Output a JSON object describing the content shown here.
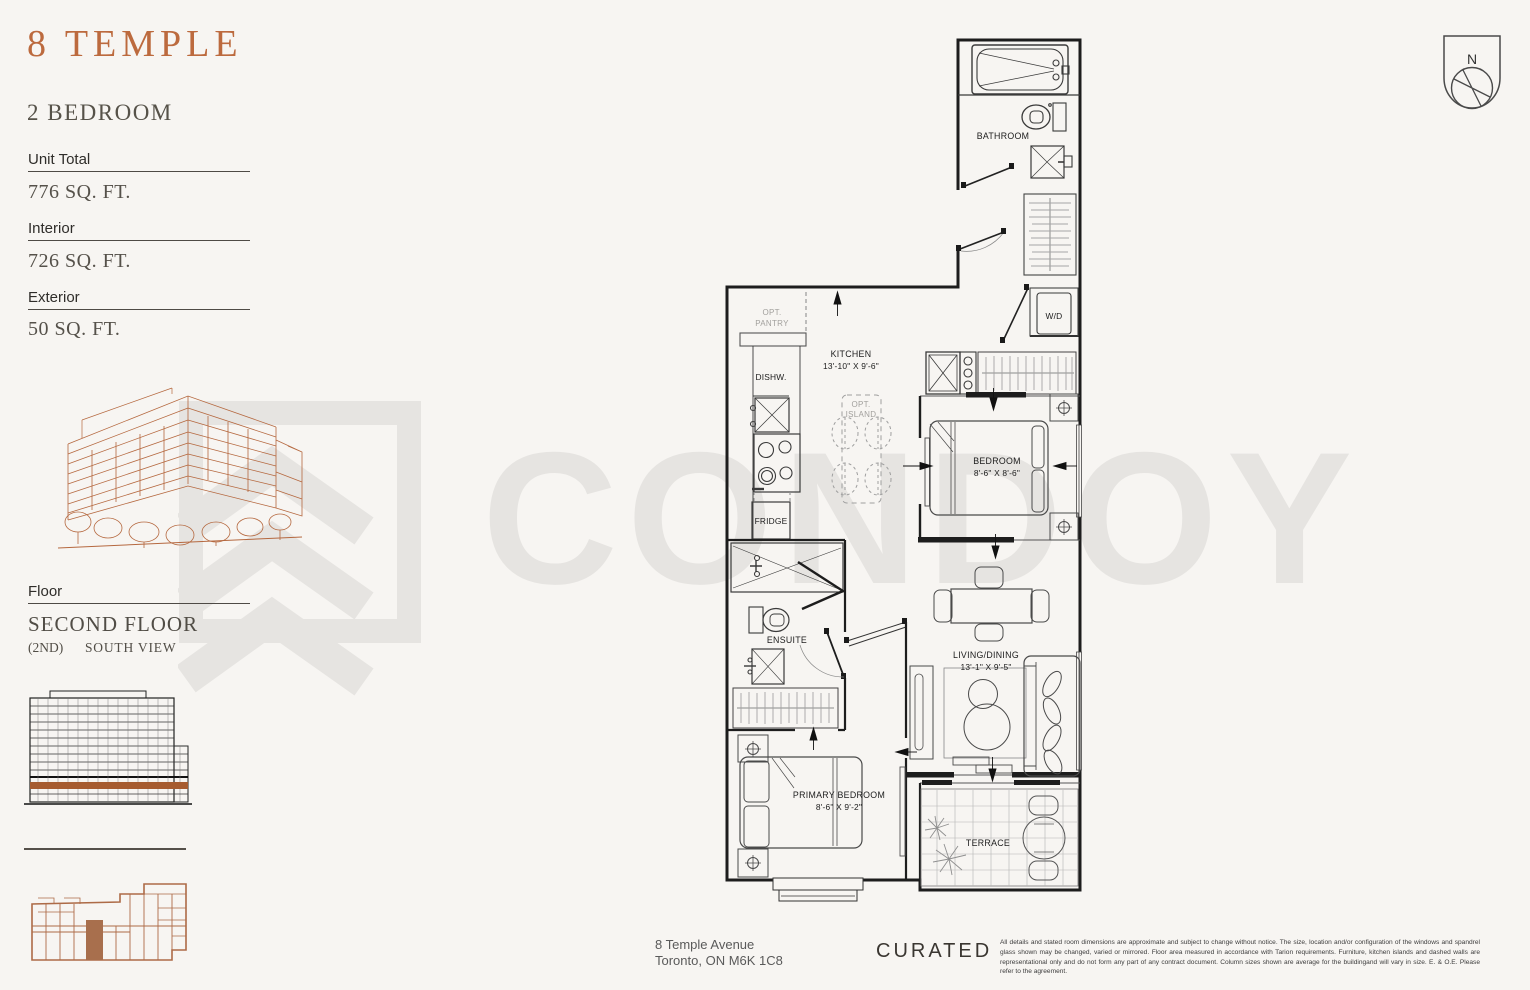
{
  "page": {
    "background": "#f7f5f2",
    "accent": "#bc6a3e",
    "watermark_color": "#e6e4e1"
  },
  "watermark": {
    "text": "CONDOY"
  },
  "sidebar": {
    "logo": "8 TEMPLE",
    "unit_type": "2 BEDROOM",
    "stats": [
      {
        "label": "Unit Total",
        "value": "776 SQ. FT."
      },
      {
        "label": "Interior",
        "value": "726 SQ. FT."
      },
      {
        "label": "Exterior",
        "value": "50 SQ. FT."
      }
    ],
    "floor": {
      "label": "Floor",
      "name": "SECOND FLOOR",
      "number": "(2ND)",
      "view": "SOUTH VIEW"
    }
  },
  "compass": {
    "north_label": "N"
  },
  "floorplan": {
    "bathroom": "BATHROOM",
    "wd": "W/D",
    "pantry_line1": "OPT.",
    "pantry_line2": "PANTRY",
    "kitchen_name": "KITCHEN",
    "kitchen_dims": "13'-10\" X 9'-6\"",
    "dishwasher": "DISHW.",
    "fridge": "FRIDGE",
    "island_line1": "OPT.",
    "island_line2": "ISLAND",
    "bedroom_name": "BEDROOM",
    "bedroom_dims": "8'-6\" X 8'-6\"",
    "ensuite": "ENSUITE",
    "living_name": "LIVING/DINING",
    "living_dims": "13'-1\" X 9'-5\"",
    "primary_name": "PRIMARY BEDROOM",
    "primary_dims": "8'-6\" X 9'-2\"",
    "terrace": "TERRACE"
  },
  "footer": {
    "address_line1": "8 Temple Avenue",
    "address_line2": "Toronto, ON M6K 1C8",
    "brand": "CURATED",
    "disclaimer": "All details and stated room dimensions are approximate and subject to change without notice. The size, location and/or configuration of the windows and spandrel glass shown may be changed, varied or mirrored. Floor area measured in accordance with Tarion requirements. Furniture, kitchen islands and dashed walls are representational only and do not form any part of any contract document. Column sizes shown are average for the buildingand will vary in size. E. & O.E. Please refer to the agreement."
  }
}
